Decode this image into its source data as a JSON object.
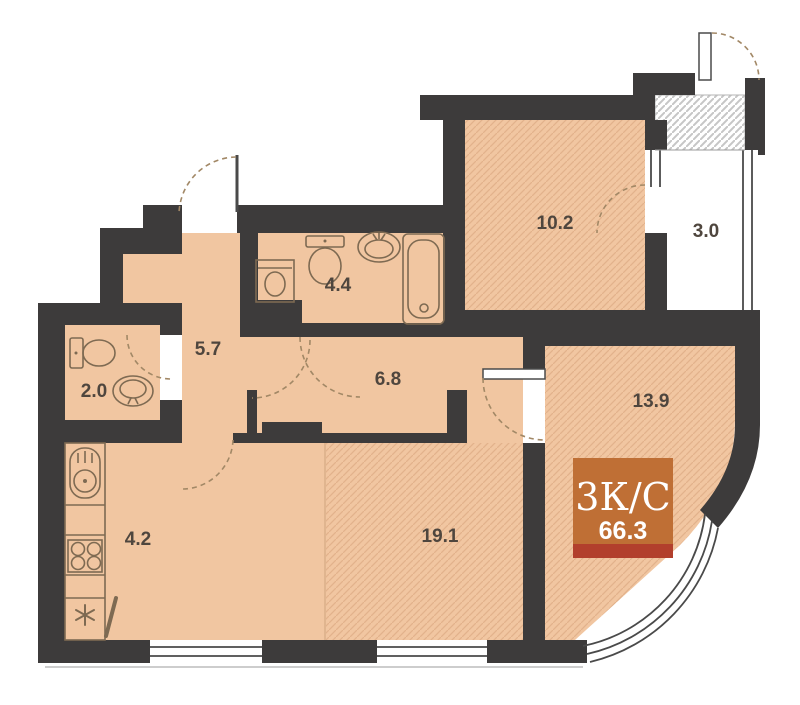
{
  "plan": {
    "title": "apartment-floor-plan",
    "badge": {
      "type_label": "3К/С",
      "total_area": "66.3"
    },
    "rooms": [
      {
        "id": "hallway",
        "area": "5.7"
      },
      {
        "id": "wc",
        "area": "2.0"
      },
      {
        "id": "bathroom",
        "area": "4.4"
      },
      {
        "id": "corridor",
        "area": "6.8"
      },
      {
        "id": "bedroom",
        "area": "10.2"
      },
      {
        "id": "balcony",
        "area": "3.0"
      },
      {
        "id": "room",
        "area": "13.9"
      },
      {
        "id": "kitchen",
        "area": "4.2"
      },
      {
        "id": "living",
        "area": "19.1"
      }
    ],
    "colors": {
      "wall": "#3d3b3b",
      "floor": "#f1c6a1",
      "floor_hatch": "#e2b28b",
      "badge_bg": "#bf6f35",
      "badge_strip": "#b23f2c",
      "label_text": "#4f463e"
    }
  }
}
